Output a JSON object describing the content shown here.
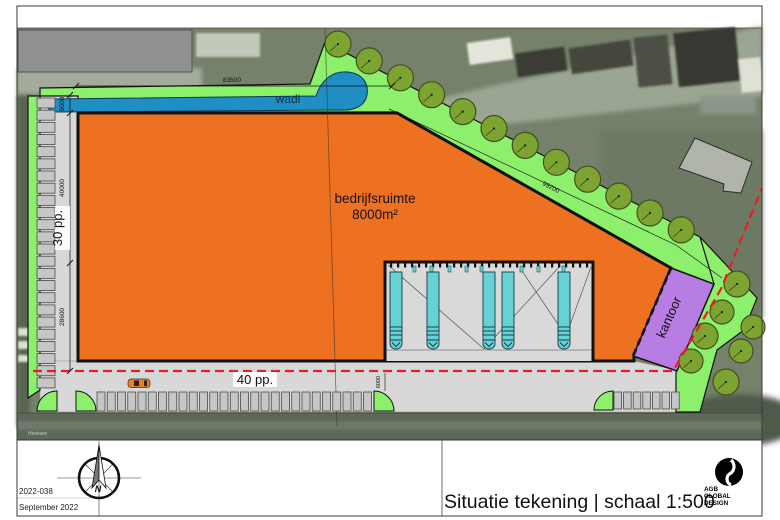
{
  "title_block": {
    "project_number": "2022-038",
    "date": "September 2022",
    "drawing_title": "Situatie tekening | schaal 1:500",
    "logo": {
      "line1": "AGB",
      "line2": "GLOBAL",
      "line3": "DESIGN"
    },
    "compass_letter": "N"
  },
  "site": {
    "street_label": "Hoekwei",
    "building_label_1": "bedrijfsruimte",
    "building_label_2": "8000m²",
    "office_label": "kantoor",
    "wadi_label": "wadi",
    "parking_left_label": "30 pp.",
    "parking_bottom_label": "40 pp."
  },
  "dimensions": {
    "north_edge": "83500",
    "west_upper": "5000",
    "west_middle": "40000",
    "west_lower": "28600",
    "diagonal_edge": "99200",
    "dock_depth": "6000"
  },
  "counts": {
    "left_stalls": 24,
    "bottom_stalls_row1": 27,
    "bottom_stalls_row2": 7,
    "dock_trucks": 5,
    "trees_top": 12,
    "trees_right": 7
  },
  "colors": {
    "building": "#ee7121",
    "office": "#b77de2",
    "green": "#8df06c",
    "tree": "#7da433",
    "tree_edge": "#3f521c",
    "wadi": "#1e8ec4",
    "truck": "#66d2d6",
    "boundary_red": "#ed1c24",
    "pavement": "#d8d8d8",
    "stall": "#c6c6c6"
  }
}
